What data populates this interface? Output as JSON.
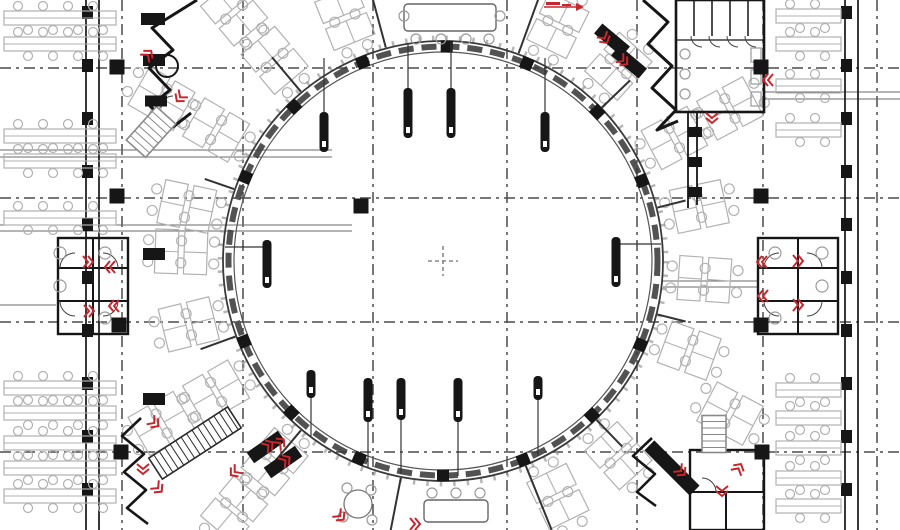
{
  "meta": {
    "drawing_type": "circular-office-floor-plan"
  },
  "colors": {
    "bg": "#ffffff",
    "wall": "#161616",
    "wall_mid": "#333333",
    "furniture": "#b1b1b1",
    "furniture_mid": "#9a9a9a",
    "grid": "#4b4b4b",
    "guide": "#6a6a6a",
    "ring": "#3a3a3a",
    "red": "#c9252c"
  },
  "plan": {
    "canvas": {
      "w": 900,
      "h": 530
    },
    "grid": {
      "x": [
        122,
        243,
        373,
        507,
        637,
        763,
        877
      ],
      "y": [
        68,
        198,
        322,
        452
      ],
      "dash": "11 5 3 5"
    },
    "ring": {
      "cx": 443,
      "cy": 261,
      "r_outer": 220,
      "r_inner": 209,
      "r_panel": 214.5,
      "panel_dash": "15 8",
      "r_tick": 223,
      "bold_tick_angles": [
        -157,
        -134,
        -112,
        -89,
        -67,
        -44,
        -22,
        23,
        46,
        68,
        90,
        113,
        135,
        158
      ]
    },
    "crosshair": {
      "x": 443,
      "y": 261,
      "size": 15
    },
    "columns": {
      "size": 15,
      "points": [
        [
          117,
          67
        ],
        [
          117,
          196
        ],
        [
          119,
          325
        ],
        [
          121,
          452
        ],
        [
          761,
          67
        ],
        [
          761,
          196
        ],
        [
          761,
          325
        ],
        [
          762,
          452
        ],
        [
          361,
          206
        ]
      ]
    },
    "hangers": [
      {
        "x": 324,
        "y": 112,
        "len": 40,
        "stem": [
          324,
          58,
          324,
          112
        ]
      },
      {
        "x": 408,
        "y": 88,
        "len": 50,
        "stem": [
          408,
          44,
          408,
          88
        ]
      },
      {
        "x": 451,
        "y": 88,
        "len": 50,
        "stem": [
          451,
          42,
          451,
          88
        ]
      },
      {
        "x": 545,
        "y": 112,
        "len": 40,
        "stem": [
          545,
          58,
          545,
          112
        ]
      },
      {
        "x": 311,
        "y": 370,
        "len": 28,
        "stem": [
          311,
          398,
          311,
          436
        ]
      },
      {
        "x": 368,
        "y": 378,
        "len": 44,
        "stem": [
          368,
          422,
          368,
          468
        ]
      },
      {
        "x": 401,
        "y": 378,
        "len": 42,
        "stem": [
          401,
          420,
          401,
          474
        ]
      },
      {
        "x": 458,
        "y": 378,
        "len": 44,
        "stem": [
          458,
          422,
          458,
          476
        ]
      },
      {
        "x": 538,
        "y": 376,
        "len": 24,
        "stem": [
          538,
          400,
          538,
          456
        ]
      },
      {
        "x": 267,
        "y": 240,
        "len": 48,
        "stem": [
          225,
          247,
          267,
          247
        ]
      },
      {
        "x": 616,
        "y": 237,
        "len": 50,
        "stem": [
          620,
          244,
          661,
          244
        ]
      }
    ],
    "facades": [
      {
        "lines_x": [
          86,
          99
        ],
        "mullion_x": 82,
        "mullion_step": 53,
        "mullion_start": 12
      },
      {
        "lines_x": [
          845,
          858
        ],
        "mullion_x": 841,
        "mullion_step": 53,
        "mullion_start": 12
      }
    ],
    "guide_lines": [
      [
        0,
        150,
        332,
        150
      ],
      [
        0,
        157,
        332,
        157
      ],
      [
        0,
        225,
        352,
        225
      ],
      [
        0,
        231,
        352,
        231
      ],
      [
        0,
        305,
        56,
        305
      ],
      [
        663,
        281,
        758,
        281
      ],
      [
        663,
        287,
        758,
        287
      ],
      [
        763,
        92,
        900,
        92
      ],
      [
        763,
        99,
        900,
        99
      ]
    ],
    "desk_rows": {
      "left": {
        "x": 4,
        "w": 112,
        "ys": [
          18,
          44,
          136,
          161,
          218,
          388,
          413,
          443,
          468,
          496
        ]
      },
      "right": {
        "x": 776,
        "w": 65,
        "ys": [
          16,
          44,
          86,
          130,
          390,
          418,
          448,
          478,
          506
        ]
      }
    },
    "desk_pods": {
      "dist1": 262,
      "row1": [
        -168,
        -150,
        -130,
        -112,
        -64,
        -48,
        -28,
        -12,
        4,
        20,
        48,
        64,
        130,
        150,
        166,
        182
      ],
      "dist2": 325,
      "row2": [
        -150,
        -130,
        -28,
        28,
        130,
        150
      ]
    },
    "partitions": [
      [
        -105,
        221,
        285
      ],
      [
        -70,
        221,
        285
      ],
      [
        -130,
        221,
        266
      ],
      [
        -44,
        221,
        260
      ],
      [
        68,
        221,
        290
      ],
      [
        101,
        221,
        290
      ],
      [
        130,
        221,
        264
      ],
      [
        46,
        221,
        258
      ],
      [
        160,
        221,
        258
      ],
      [
        -161,
        221,
        252
      ],
      [
        14,
        221,
        250
      ],
      [
        -14,
        221,
        250
      ]
    ],
    "wall_polylines": [
      {
        "w": 3,
        "pts": [
          [
            197,
            0
          ],
          [
            152,
            28
          ],
          [
            173,
            50
          ],
          [
            149,
            68
          ],
          [
            170,
            90
          ],
          [
            150,
            106
          ],
          [
            173,
            127
          ],
          [
            191,
            113
          ]
        ]
      },
      {
        "w": 3,
        "pts": [
          [
            643,
            0
          ],
          [
            668,
            22
          ],
          [
            648,
            44
          ],
          [
            672,
            66
          ],
          [
            652,
            88
          ],
          [
            676,
            110
          ],
          [
            657,
            130
          ],
          [
            678,
            121
          ]
        ]
      },
      {
        "w": 2.6,
        "pts": [
          [
            141,
            418
          ],
          [
            122,
            436
          ],
          [
            144,
            454
          ],
          [
            124,
            472
          ],
          [
            146,
            490
          ],
          [
            127,
            508
          ],
          [
            148,
            524
          ]
        ]
      },
      {
        "w": 2.6,
        "pts": [
          [
            652,
            438
          ],
          [
            633,
            456
          ],
          [
            655,
            474
          ],
          [
            637,
            492
          ],
          [
            656,
            506
          ]
        ]
      }
    ],
    "wall_rects": [
      {
        "x": 58,
        "y": 238,
        "w": 70,
        "h": 96,
        "sw": 2.4
      },
      {
        "x": 758,
        "y": 238,
        "w": 80,
        "h": 96,
        "sw": 2.4
      },
      {
        "x": 676,
        "y": 0,
        "w": 88,
        "h": 112,
        "sw": 2.6
      },
      {
        "x": 690,
        "y": 450,
        "w": 74,
        "h": 80,
        "sw": 2.4
      }
    ],
    "wall_lines": [
      [
        93,
        238,
        93,
        334,
        2
      ],
      [
        58,
        268,
        128,
        268,
        2
      ],
      [
        58,
        301,
        128,
        301,
        2
      ],
      [
        798,
        238,
        798,
        334,
        2
      ],
      [
        758,
        268,
        838,
        268,
        2
      ],
      [
        758,
        301,
        838,
        301,
        2
      ],
      [
        694,
        0,
        694,
        36,
        1.5
      ],
      [
        712,
        0,
        712,
        36,
        1.5
      ],
      [
        730,
        0,
        730,
        36,
        1.5
      ],
      [
        748,
        0,
        748,
        36,
        1.5
      ],
      [
        676,
        40,
        764,
        40,
        1.2
      ],
      [
        690,
        492,
        764,
        492,
        2
      ],
      [
        726,
        492,
        726,
        530,
        2
      ],
      [
        688,
        112,
        688,
        208,
        1.8
      ],
      [
        697,
        112,
        697,
        205,
        1.8
      ]
    ],
    "door_arcs": [
      [
        75,
        268,
        15,
        180,
        270
      ],
      [
        103,
        268,
        15,
        270,
        360
      ],
      [
        75,
        301,
        15,
        90,
        180
      ],
      [
        103,
        301,
        15,
        0,
        90
      ],
      [
        779,
        268,
        15,
        180,
        270
      ],
      [
        807,
        268,
        15,
        270,
        360
      ],
      [
        779,
        301,
        15,
        90,
        180
      ],
      [
        807,
        301,
        15,
        0,
        90
      ],
      [
        702,
        36,
        11,
        90,
        180
      ],
      [
        720,
        36,
        11,
        90,
        180
      ],
      [
        738,
        36,
        11,
        90,
        180
      ],
      [
        756,
        36,
        11,
        90,
        180
      ],
      [
        702,
        492,
        14,
        270,
        360
      ],
      [
        173,
        108,
        12,
        180,
        270
      ]
    ],
    "fixture_circles": [
      [
        60,
        253,
        6
      ],
      [
        60,
        286,
        6
      ],
      [
        105,
        253,
        6
      ],
      [
        105,
        318,
        6
      ],
      [
        822,
        253,
        6
      ],
      [
        822,
        286,
        6
      ],
      [
        775,
        253,
        6
      ],
      [
        775,
        318,
        6
      ],
      [
        685,
        54,
        5
      ],
      [
        685,
        74,
        5
      ],
      [
        685,
        94,
        5
      ]
    ],
    "fixture_circles_dark": [
      [
        167,
        66,
        11
      ]
    ],
    "fixture_rects": [
      [
        751,
        48,
        10,
        14
      ],
      [
        751,
        70,
        10,
        14
      ],
      [
        751,
        92,
        10,
        14
      ]
    ],
    "stairs": [
      {
        "cx": 195,
        "cy": 443,
        "w": 94,
        "h": 25,
        "a": -33,
        "dark": true
      },
      {
        "cx": 714,
        "cy": 434,
        "w": 37,
        "h": 24,
        "a": 90,
        "dark": false
      },
      {
        "cx": 151,
        "cy": 132,
        "w": 45,
        "h": 26,
        "a": -48,
        "dark": false
      }
    ],
    "dark_rects": [
      {
        "cx": 266,
        "cy": 447,
        "w": 38,
        "h": 13,
        "a": -35
      },
      {
        "cx": 283,
        "cy": 462,
        "w": 38,
        "h": 13,
        "a": -35
      },
      {
        "cx": 612,
        "cy": 40,
        "w": 36,
        "h": 13,
        "a": 40
      },
      {
        "cx": 629,
        "cy": 62,
        "w": 36,
        "h": 13,
        "a": 40
      },
      {
        "cx": 672,
        "cy": 468,
        "w": 64,
        "h": 14,
        "a": 45
      },
      {
        "cx": 153,
        "cy": 19,
        "w": 24,
        "h": 12,
        "a": 0
      },
      {
        "cx": 154,
        "cy": 60,
        "w": 22,
        "h": 12,
        "a": 0
      },
      {
        "cx": 156,
        "cy": 101,
        "w": 22,
        "h": 11,
        "a": 0
      },
      {
        "cx": 154,
        "cy": 254,
        "w": 22,
        "h": 12,
        "a": 0
      },
      {
        "cx": 154,
        "cy": 399,
        "w": 22,
        "h": 12,
        "a": 0
      },
      {
        "cx": 695,
        "cy": 132,
        "w": 14,
        "h": 10,
        "a": 0
      },
      {
        "cx": 695,
        "cy": 162,
        "w": 14,
        "h": 10,
        "a": 0
      },
      {
        "cx": 695,
        "cy": 192,
        "w": 14,
        "h": 10,
        "a": 0
      }
    ],
    "tables": {
      "rects": [
        {
          "x": 404,
          "y": 4,
          "w": 92,
          "h": 27
        },
        {
          "x": 424,
          "y": 500,
          "w": 64,
          "h": 22
        }
      ],
      "rounds": [
        {
          "cx": 358,
          "cy": 504,
          "r": 14
        }
      ],
      "chairs": [
        [
          416,
          39
        ],
        [
          441,
          39
        ],
        [
          466,
          39
        ],
        [
          489,
          39
        ],
        [
          404,
          16
        ],
        [
          500,
          16
        ],
        [
          432,
          493
        ],
        [
          456,
          493
        ],
        [
          480,
          493
        ],
        [
          347,
          488
        ],
        [
          371,
          490
        ],
        [
          343,
          517
        ],
        [
          372,
          520
        ]
      ]
    },
    "red_marks": [
      [
        146,
        57,
        -50
      ],
      [
        182,
        95,
        130
      ],
      [
        603,
        36,
        60
      ],
      [
        621,
        59,
        40
      ],
      [
        712,
        115,
        90
      ],
      [
        771,
        80,
        180
      ],
      [
        85,
        262,
        0
      ],
      [
        113,
        267,
        180
      ],
      [
        86,
        311,
        0
      ],
      [
        117,
        306,
        180
      ],
      [
        765,
        262,
        180
      ],
      [
        795,
        261,
        0
      ],
      [
        766,
        296,
        180
      ],
      [
        795,
        305,
        0
      ],
      [
        152,
        421,
        40
      ],
      [
        143,
        466,
        90
      ],
      [
        156,
        486,
        45
      ],
      [
        237,
        470,
        140
      ],
      [
        278,
        445,
        -45
      ],
      [
        266,
        447,
        -35
      ],
      [
        283,
        462,
        -35
      ],
      [
        679,
        469,
        45
      ],
      [
        737,
        471,
        -60
      ],
      [
        722,
        488,
        90
      ],
      [
        412,
        524,
        0
      ],
      [
        338,
        514,
        45
      ]
    ],
    "red_leader": {
      "bars": [
        [
          546,
          2,
          14,
          3
        ],
        [
          562,
          4,
          9,
          2
        ]
      ],
      "line": [
        544,
        7,
        576,
        7
      ],
      "arrow": [
        [
          576,
          3
        ],
        [
          584,
          7
        ],
        [
          576,
          11
        ]
      ]
    }
  }
}
